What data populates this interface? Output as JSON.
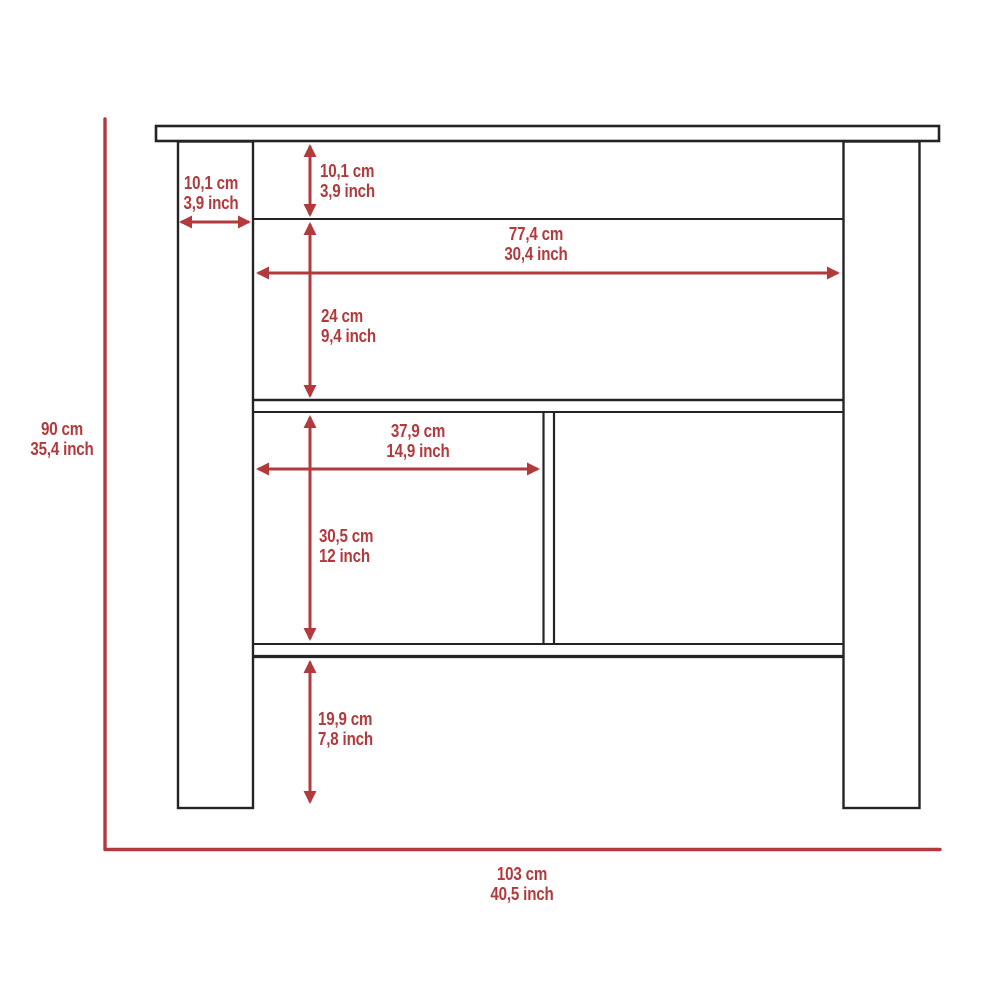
{
  "diagram": {
    "kind": "furniture-dimension-diagram",
    "view": "front-elevation",
    "units": [
      "cm",
      "inch"
    ]
  },
  "colors": {
    "dimension_red": "#b23a3d",
    "outline_black": "#242424",
    "background": "#ffffff"
  },
  "labels": {
    "overall_height": {
      "cm": "90 cm",
      "inch": "35,4 inch"
    },
    "overall_width": {
      "cm": "103 cm",
      "inch": "40,5 inch"
    },
    "top_gap": {
      "cm": "10,1 cm",
      "inch": "3,9 inch"
    },
    "leg_width": {
      "cm": "10,1 cm",
      "inch": "3,9 inch"
    },
    "inner_width": {
      "cm": "77,4 cm",
      "inch": "30,4 inch"
    },
    "upper_height": {
      "cm": "24 cm",
      "inch": "9,4 inch"
    },
    "cubby_width": {
      "cm": "37,9 cm",
      "inch": "14,9 inch"
    },
    "cubby_height": {
      "cm": "30,5 cm",
      "inch": "12 inch"
    },
    "bottom_clearance": {
      "cm": "19,9 cm",
      "inch": "7,8 inch"
    }
  }
}
